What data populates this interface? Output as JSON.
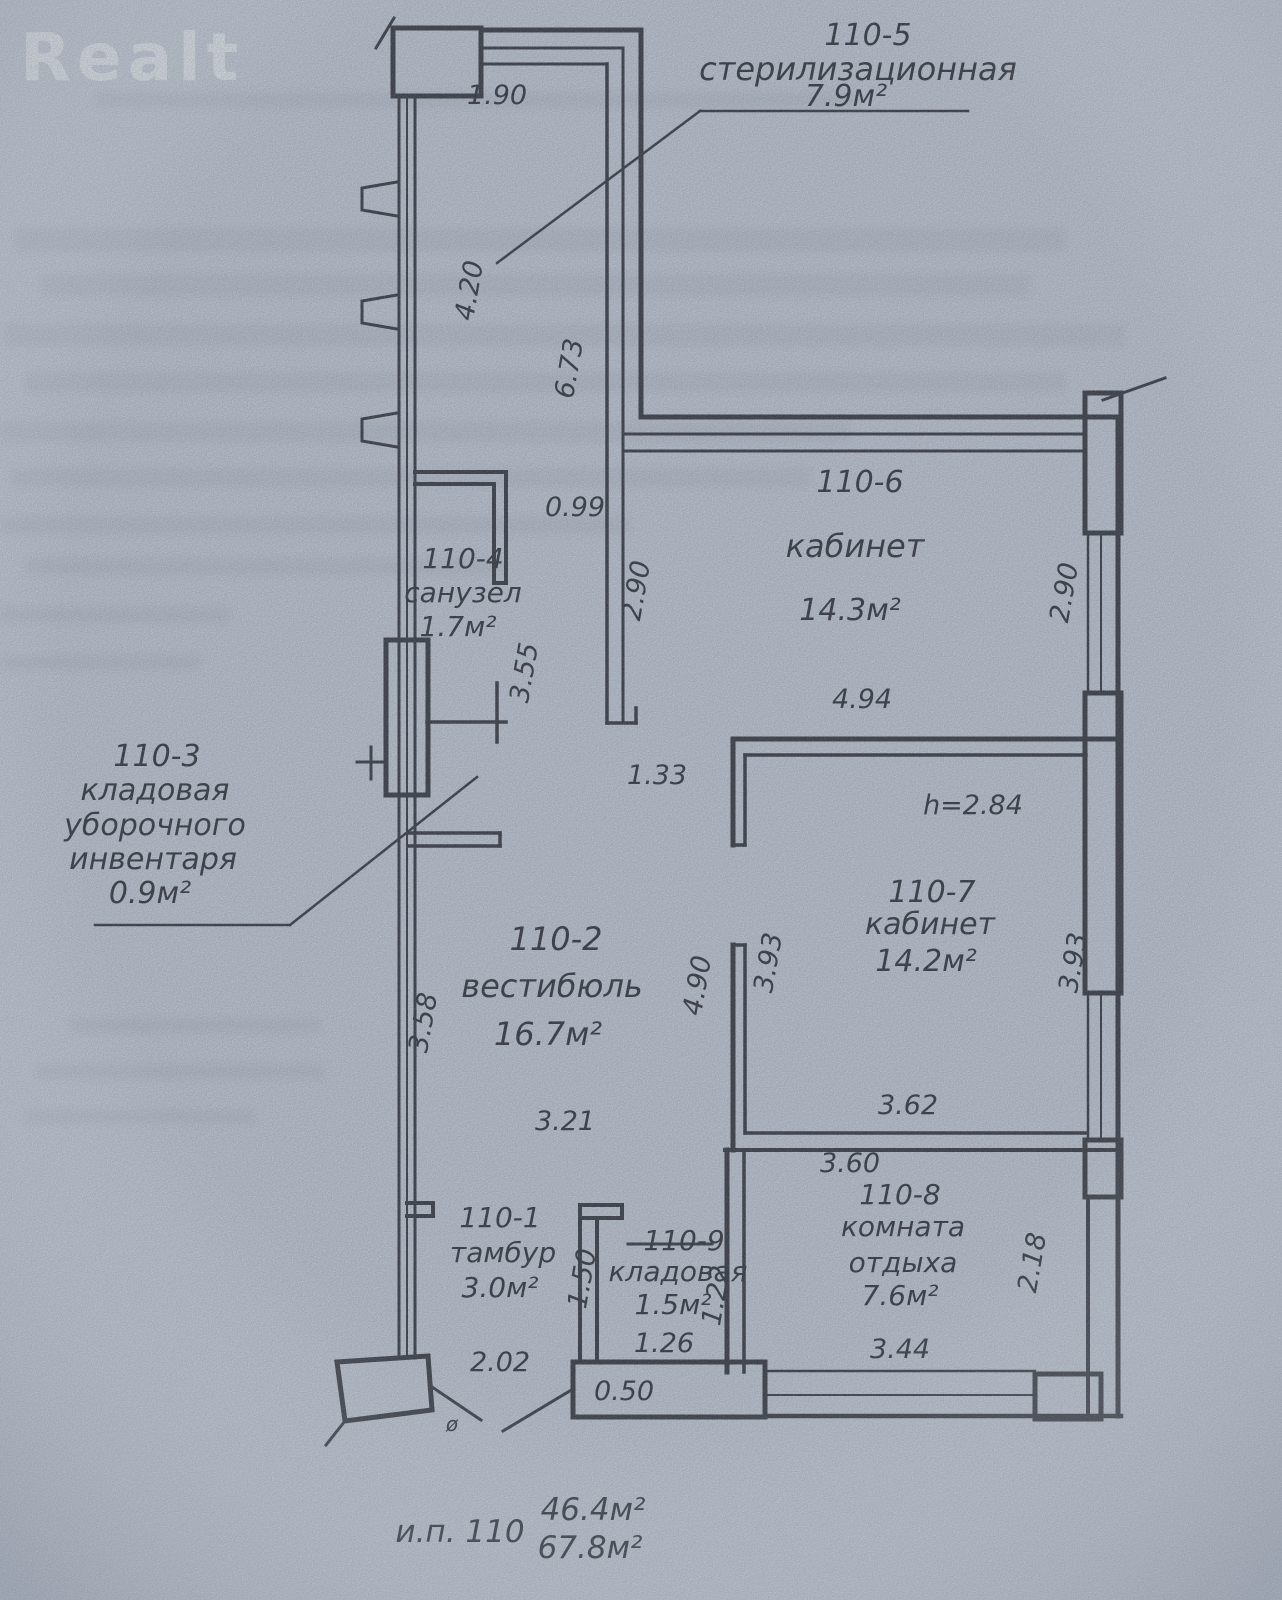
{
  "watermark": "Realt",
  "colors": {
    "paper": "#c6ced9",
    "ink": "#2b2d34",
    "watermark": "#eef1f5"
  },
  "plan": {
    "rooms": {
      "r5": {
        "num": "110-5",
        "name": "стерилизационная",
        "area": "7.9м²"
      },
      "r6": {
        "num": "110-6",
        "name": "кабинет",
        "area": "14.3м²"
      },
      "r4": {
        "num": "110-4",
        "name": "санузел",
        "area": "1.7м²"
      },
      "r3": {
        "num": "110-3",
        "name1": "кладовая",
        "name2": "уборочного",
        "name3": "инвентаря",
        "area": "0.9м²"
      },
      "r2": {
        "num": "110-2",
        "name": "вестибюль",
        "area": "16.7м²"
      },
      "r7": {
        "num": "110-7",
        "name": "кабинет",
        "area": "14.2м²"
      },
      "r8": {
        "num": "110-8",
        "name1": "комната",
        "name2": "отдыха",
        "area": "7.6м²"
      },
      "r1": {
        "num": "110-1",
        "name": "тамбур",
        "area": "3.0м²"
      },
      "r9": {
        "num": "110-9",
        "name": "кладовая",
        "area": "1.5м²"
      }
    },
    "dims": {
      "w190": "1.90",
      "w420": "4.20",
      "w673": "6.73",
      "w099": "0.99",
      "w355": "3.55",
      "w290l": "2.90",
      "w494": "4.94",
      "w290r": "2.90",
      "w133": "1.33",
      "height": "h=2.84",
      "w393l": "3.93",
      "w393r": "3.93",
      "w490": "4.90",
      "w358": "3.58",
      "w321": "3.21",
      "w362": "3.62",
      "w360": "3.60",
      "w218": "2.18",
      "w344": "3.44",
      "w150": "1.50",
      "w126": "1.26",
      "w122": "1.22",
      "w202": "2.02",
      "w050": "0.50",
      "door": "ø"
    },
    "footer": {
      "unit": "и.п. 110",
      "area1": "46.4м²",
      "area2": "67.8м²"
    }
  }
}
